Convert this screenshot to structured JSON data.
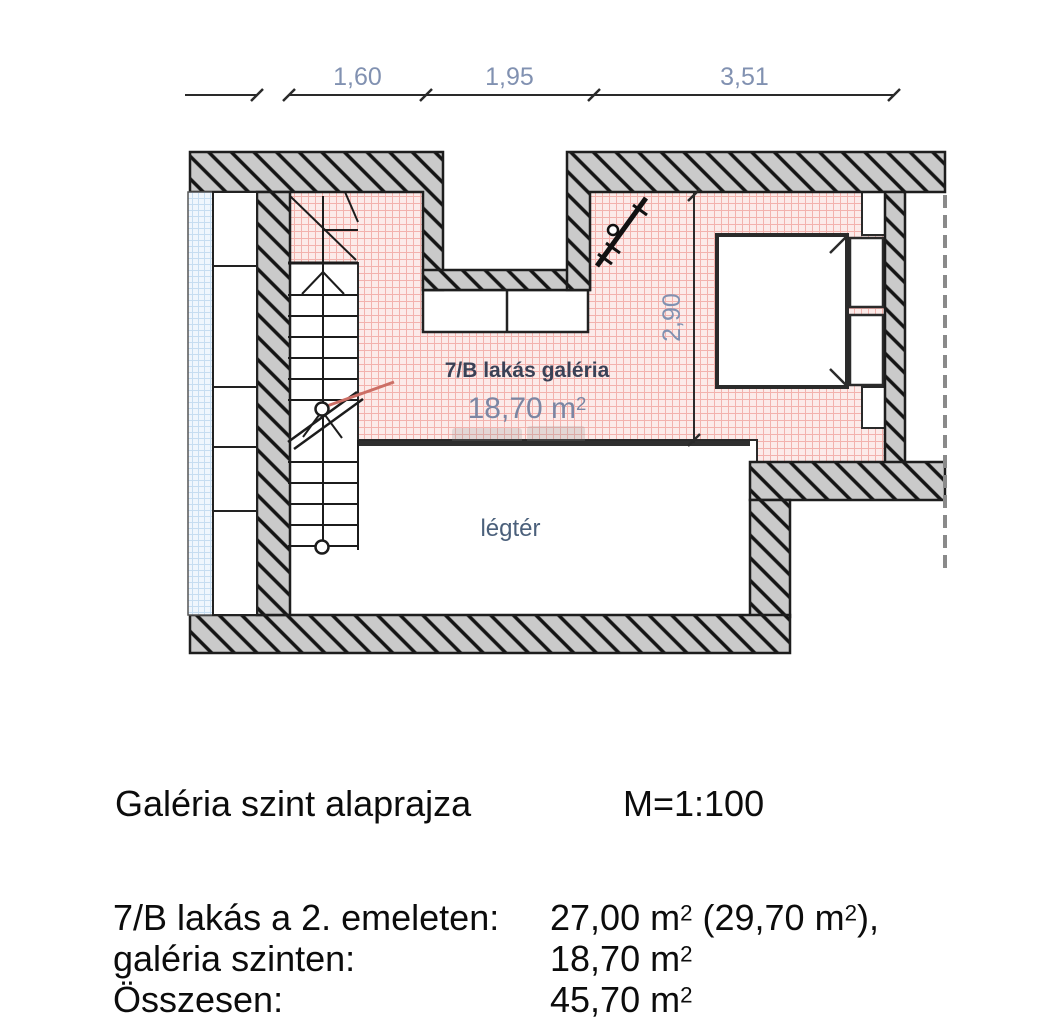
{
  "plan": {
    "dimensions": {
      "top": [
        "1,60",
        "1,95",
        "3,51"
      ],
      "vertical": "2,90"
    },
    "labels": {
      "gallery_name": "7/B lakás galéria",
      "gallery_area": "18,70 m²",
      "void": "légtér"
    },
    "legend": {
      "gallery_fill": "#fcebe9",
      "gallery_grid": "#f3b2ad",
      "wall_fill": "#cacaca",
      "wall_hatch": "#141414",
      "neighbour_fill": "#eff6fd",
      "neighbour_grid": "#c6ddf1",
      "dimension_color": "#8191b1"
    }
  },
  "title_block": {
    "title": "Galéria szint alaprajza",
    "scale": "M=1:100"
  },
  "area_table": {
    "rows": [
      {
        "label": "7/B lakás a 2. emeleten:",
        "value": "27,00 m² (29,70 m²),"
      },
      {
        "label": "galéria szinten:",
        "value": "18,70 m²"
      },
      {
        "label": "Összesen:",
        "value": "45,70 m²"
      }
    ]
  }
}
